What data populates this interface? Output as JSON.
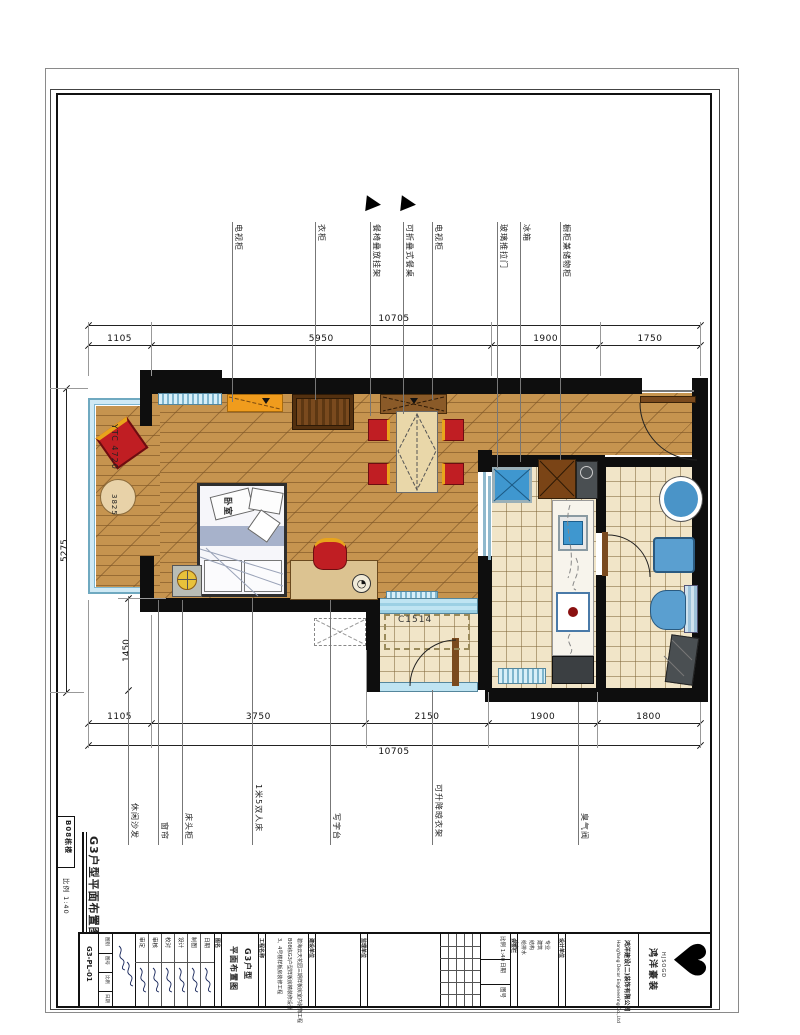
{
  "sheet": {
    "building": "B08栋楼",
    "scale_label": "比例 1:40",
    "title": "G3户型平面布置图",
    "drawing_no": "G3-PL-01",
    "room_label": "卧室",
    "window_code_left": "YTC 4720",
    "window_code_bottom": "C1514"
  },
  "dimensions": {
    "top": {
      "overall": "10705",
      "segments": [
        "1105",
        "5950",
        "1900",
        "1750"
      ]
    },
    "bottom": {
      "overall": "10705",
      "segments": [
        "1105",
        "3750",
        "2150",
        "1900",
        "1800"
      ]
    },
    "left": {
      "overall": "5275",
      "upper": "3825",
      "lower": "1450"
    }
  },
  "callouts_top": [
    {
      "label": "电视柜",
      "x": 232,
      "end": 402
    },
    {
      "label": "衣柜",
      "x": 315,
      "end": 400
    },
    {
      "label": "餐椅叠放挂架",
      "x": 370,
      "end": 416
    },
    {
      "label": "可折叠式餐桌",
      "x": 403,
      "end": 414
    },
    {
      "label": "电视柜",
      "x": 432,
      "end": 400
    },
    {
      "label": "玻璃推拉门",
      "x": 497,
      "end": 468
    },
    {
      "label": "冰箱",
      "x": 520,
      "end": 462
    },
    {
      "label": "橱柜兼储物柜",
      "x": 560,
      "end": 460
    }
  ],
  "callouts_bottom": [
    {
      "label": "休闲沙发",
      "x": 128,
      "start": 596
    },
    {
      "label": "窗帘",
      "x": 158,
      "start": 600
    },
    {
      "label": "床头柜",
      "x": 182,
      "start": 600
    },
    {
      "label": "1米5双人床",
      "x": 252,
      "start": 598
    },
    {
      "label": "写字台",
      "x": 330,
      "start": 600
    },
    {
      "label": "可升降晾衣架",
      "x": 432,
      "start": 690
    },
    {
      "label": "臭气阀",
      "x": 578,
      "start": 702
    }
  ],
  "section_markers": [
    {
      "x": 366,
      "y": 196
    },
    {
      "x": 401,
      "y": 196
    }
  ],
  "titleblock": {
    "labels": {
      "tubie": "图别",
      "tuhao": "图号",
      "bili": "比例",
      "riqi": "日期",
      "tuming": "图名",
      "gongcheng": "工程名称",
      "jianshe": "建设单位",
      "jianli": "监理单位",
      "huiqian": "会签栏",
      "sheji": "设计单位"
    },
    "scale_value": "1:40",
    "drawing_name": [
      "G3户型",
      "平面布置图"
    ],
    "project_lines": [
      "碧海云天花园三期样板房室内装饰工程",
      "B08栋G3户型样板房精装修设计",
      "3、4号楼样板房装修工程"
    ],
    "roles": [
      "审定",
      "审核",
      "校对",
      "设计",
      "制图",
      "日期"
    ],
    "huiqian_lines": [
      "专业",
      "建筑",
      "结构",
      "给排水",
      "电气"
    ],
    "company_cn": "鸿洋建设(二)装饰有限公司",
    "company_en": "HongYang Decor Engineering Co.,Ltd",
    "brand": "HJSOGD",
    "brand_cn": "鸿洋豪装",
    "logo_glyph": "♥"
  }
}
